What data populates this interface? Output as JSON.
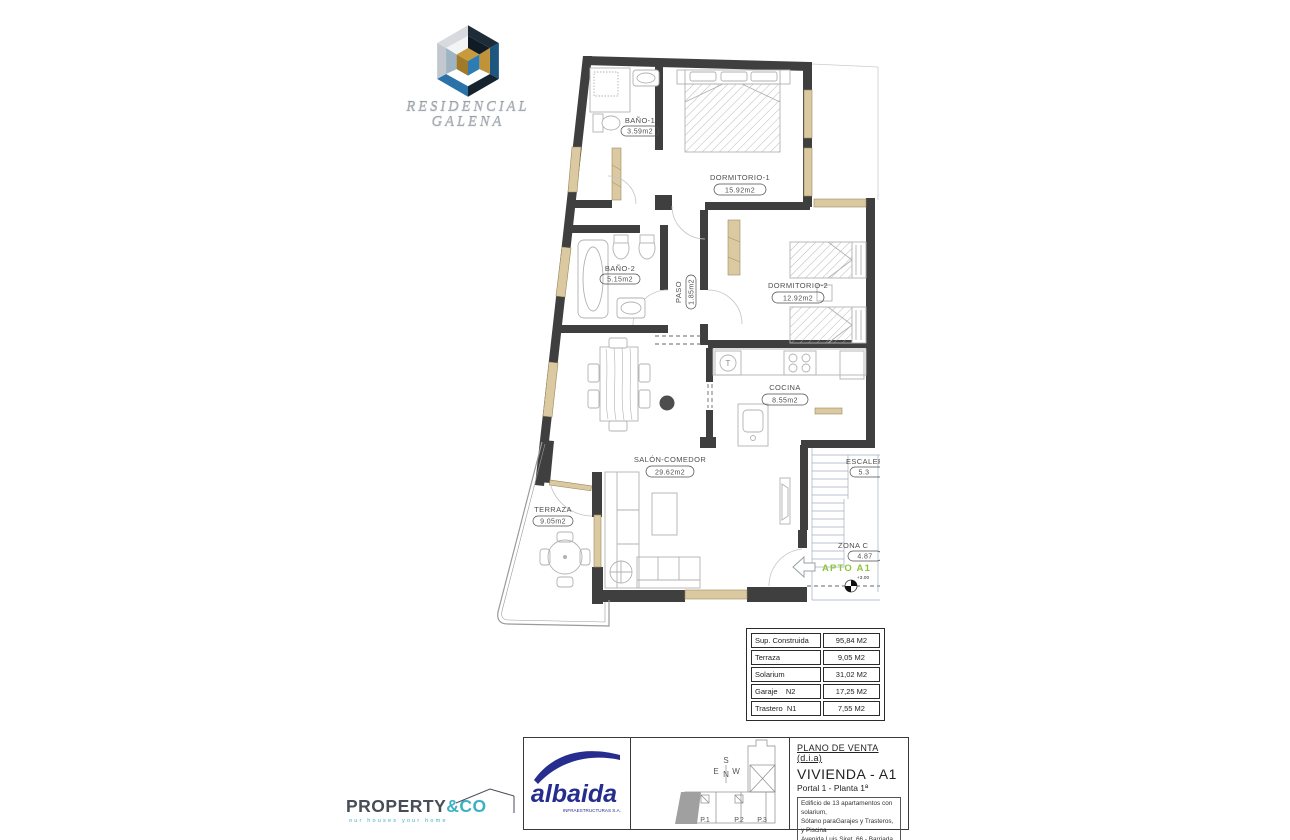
{
  "developer_logo": {
    "title_line1": "RESIDENCIAL",
    "title_line2": "GALENA"
  },
  "plan": {
    "rooms": [
      {
        "name": "BAÑO-1",
        "area": "3.59m2"
      },
      {
        "name": "DORMITORIO-1",
        "area": "15.92m2"
      },
      {
        "name": "BAÑO-2",
        "area": "5.15m2"
      },
      {
        "name": "PASO",
        "area": "1.85m2"
      },
      {
        "name": "DORMITORIO-2",
        "area": "12.92m2"
      },
      {
        "name": "COCINA",
        "area": "8.55m2"
      },
      {
        "name": "SALÓN-COMEDOR",
        "area": "29.62m2"
      },
      {
        "name": "TERRAZA",
        "area": "9.05m2"
      },
      {
        "name": "ESCALERA",
        "area": "5.3"
      },
      {
        "name": "ZONA C",
        "area": "4.87"
      }
    ],
    "apartment_label": "APTO A1",
    "level_marker": "+3.00",
    "accent_green": "#8bc53f",
    "wall_color": "#3f3f3f",
    "window_color": "#dbc9a2"
  },
  "areas_table": {
    "rows": [
      {
        "label": "Sup. Construida",
        "value": "95,84 M2"
      },
      {
        "label": "Terraza",
        "value": "9,05 M2"
      },
      {
        "label": "Solarium",
        "value": "31,02 M2"
      },
      {
        "label": "Garaje    N2",
        "value": "17,25 M2"
      },
      {
        "label": "Trastero  N1",
        "value": "7,55 M2"
      }
    ]
  },
  "title_block": {
    "plan_type": "PLANO DE VENTA (d.i.a)",
    "dwelling": "VIVIENDA - A1",
    "portal": "Portal 1 - Planta 1ª",
    "description_lines": [
      "Edificio de 13 apartamentos con solarium,",
      "Sótano paraGarajes y Trasteros, y Piscina",
      "Avenida Luis Siret, 66 - Barriada HERRERÍAS",
      "T.M. CUEVAS DE ALMANZORA (Almería)"
    ],
    "key_plan": {
      "compass_s": "S",
      "compass_e": "E",
      "compass_n": "N",
      "compass_w": "W",
      "portals": [
        {
          "label": "P.1"
        },
        {
          "label": "P.2"
        },
        {
          "label": "P.3"
        }
      ]
    }
  },
  "brands": {
    "albaida": {
      "name": "albaida",
      "subtitle": "INFRAESTRUCTURAS S.A.",
      "color": "#262d8e"
    },
    "property": {
      "name_main": "PROPERTY",
      "name_accent": "&CO",
      "tagline": "our houses your home",
      "dark": "#474e57",
      "teal": "#3cb1c3"
    }
  }
}
